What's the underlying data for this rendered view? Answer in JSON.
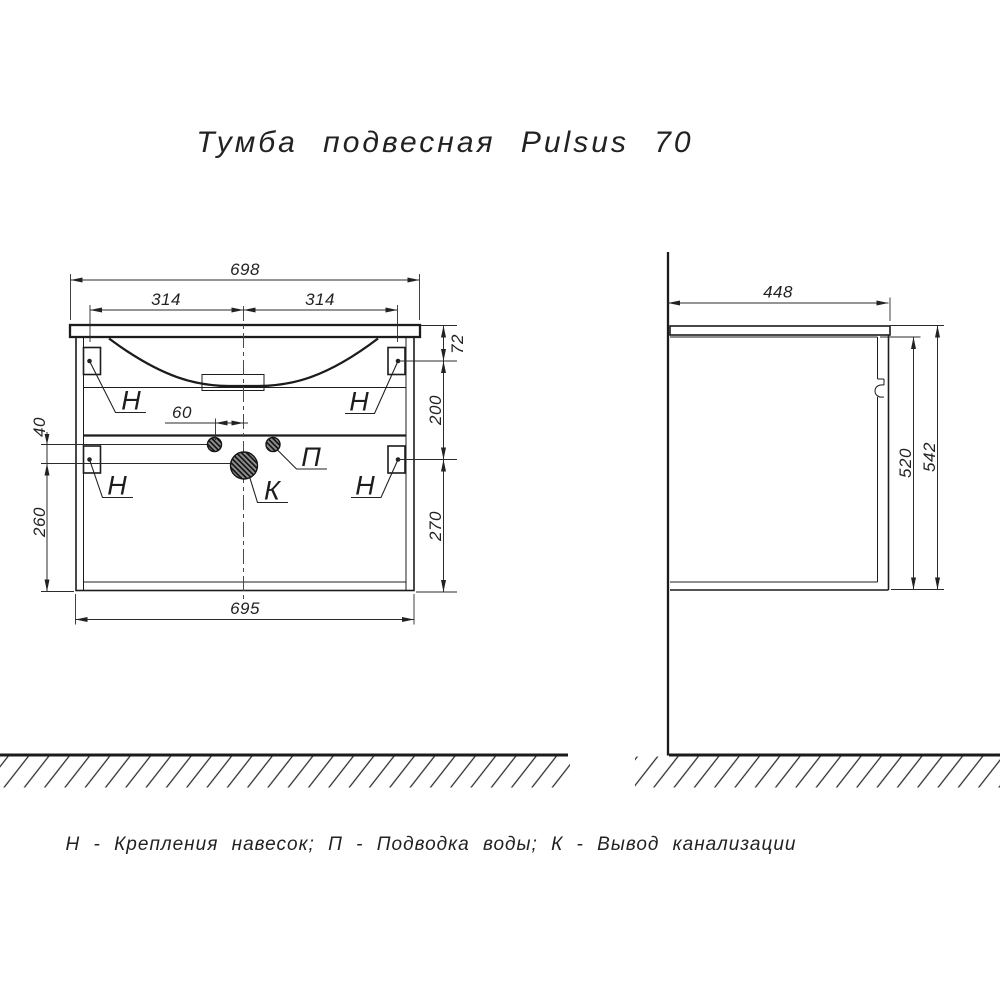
{
  "title": "Тумба подвесная Pulsus 70",
  "legend": "Н - Крепления навесок; П - Подводка воды; К - Вывод канализации",
  "front_view": {
    "dims": {
      "top_width": "698",
      "left_half": "314",
      "right_half": "314",
      "top_to_bracket": "72",
      "bracket_spacing": "200",
      "bracket_to_bottom": "270",
      "supply_to_drain": "40",
      "drain_to_bottom": "260",
      "body_width": "695",
      "drain_offset": "60"
    },
    "labels": {
      "bracket": "Н",
      "water": "П",
      "drain": "К"
    }
  },
  "side_view": {
    "dims": {
      "depth": "448",
      "front_height": "520",
      "total_height": "542"
    }
  }
}
